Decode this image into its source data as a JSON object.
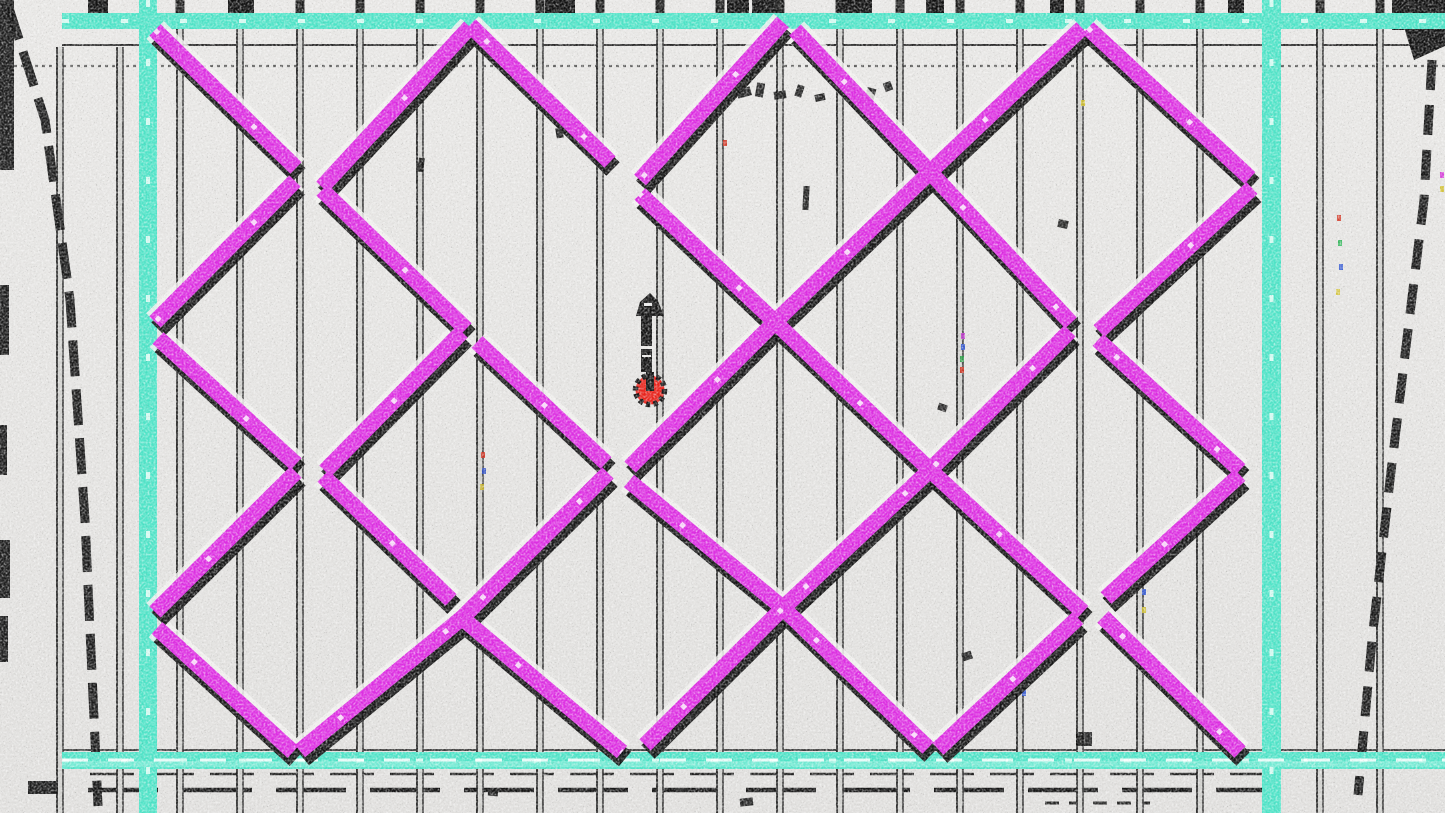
{
  "meta": {
    "title": "Colorized blueprint maze — red player token with up arrow"
  },
  "canvas": {
    "width": 1445,
    "height": 813
  },
  "colors": {
    "background": "#e2e1df",
    "background_top": "#e7e6e4",
    "wall": "#dd2fe2",
    "wall_shadow": "#0c0c0c",
    "wall_halo": "#f2f1ef",
    "wall_fleck": "#ffffff",
    "frame": "#4fe3c7",
    "frame_light": "#8ff0dd",
    "frame_speckle": "#f4fffb",
    "post_core": "#cfcfcc",
    "post_edge": "#1a1a1a",
    "ink": "#111111",
    "player": "#e8241c",
    "arrow": "#141414"
  },
  "frame": {
    "top": {
      "x": 62,
      "y": 13,
      "w": 1383,
      "h": 16
    },
    "bottom": {
      "x": 62,
      "y": 752,
      "w": 1383,
      "h": 17
    },
    "left": {
      "x": 139,
      "y": 0,
      "w": 18,
      "h": 813
    },
    "right": {
      "x": 1262,
      "y": 0,
      "w": 19,
      "h": 813
    }
  },
  "posts": {
    "width": 7,
    "items": [
      {
        "x": 60,
        "top": 47
      },
      {
        "x": 120,
        "top": 47
      },
      {
        "x": 180,
        "top": 0
      },
      {
        "x": 240,
        "top": 0
      },
      {
        "x": 300,
        "top": 0
      },
      {
        "x": 360,
        "top": 0
      },
      {
        "x": 420,
        "top": 0
      },
      {
        "x": 480,
        "top": 0
      },
      {
        "x": 540,
        "top": 0
      },
      {
        "x": 600,
        "top": 0
      },
      {
        "x": 660,
        "top": 0
      },
      {
        "x": 720,
        "top": 0
      },
      {
        "x": 780,
        "top": 0
      },
      {
        "x": 840,
        "top": 0
      },
      {
        "x": 900,
        "top": 0
      },
      {
        "x": 960,
        "top": 0
      },
      {
        "x": 1020,
        "top": 0
      },
      {
        "x": 1080,
        "top": 0
      },
      {
        "x": 1140,
        "top": 0
      },
      {
        "x": 1200,
        "top": 0
      },
      {
        "x": 1320,
        "top": 0
      },
      {
        "x": 1380,
        "top": 0
      }
    ]
  },
  "walls": {
    "width": 16,
    "shadow_width": 19,
    "shadow_dx": 3,
    "shadow_dy": 7,
    "segments": [
      [
        155,
        30,
        296,
        168
      ],
      [
        322,
        190,
        466,
        329
      ],
      [
        477,
        342,
        606,
        463
      ],
      [
        629,
        481,
        783,
        608
      ],
      [
        783,
        608,
        928,
        748
      ],
      [
        470,
        25,
        610,
        162
      ],
      [
        640,
        194,
        775,
        322
      ],
      [
        775,
        322,
        930,
        470
      ],
      [
        930,
        470,
        1083,
        612
      ],
      [
        795,
        30,
        930,
        172
      ],
      [
        930,
        172,
        1071,
        323
      ],
      [
        1098,
        340,
        1240,
        470
      ],
      [
        1088,
        28,
        1250,
        178
      ],
      [
        158,
        338,
        296,
        464
      ],
      [
        323,
        476,
        451,
        600
      ],
      [
        462,
        618,
        622,
        752
      ],
      [
        157,
        628,
        293,
        752
      ],
      [
        1103,
        617,
        1240,
        752
      ],
      [
        155,
        322,
        295,
        181
      ],
      [
        322,
        187,
        470,
        27
      ],
      [
        325,
        471,
        462,
        332
      ],
      [
        155,
        612,
        296,
        472
      ],
      [
        300,
        751,
        462,
        618
      ],
      [
        462,
        618,
        608,
        473
      ],
      [
        640,
        180,
        783,
        22
      ],
      [
        630,
        467,
        775,
        322
      ],
      [
        775,
        322,
        929,
        173
      ],
      [
        929,
        173,
        1082,
        28
      ],
      [
        645,
        745,
        783,
        608
      ],
      [
        783,
        608,
        929,
        471
      ],
      [
        930,
        470,
        1070,
        331
      ],
      [
        1099,
        331,
        1252,
        188
      ],
      [
        938,
        749,
        1078,
        618
      ],
      [
        1106,
        598,
        1240,
        475
      ]
    ]
  },
  "guides": [
    {
      "x1": 62,
      "y1": 45,
      "x2": 1445,
      "y2": 45,
      "w": 2,
      "dash": "none",
      "color": "#1a1a1a",
      "opacity": 0.9
    },
    {
      "x1": 0,
      "y1": 66,
      "x2": 1445,
      "y2": 66,
      "w": 2.2,
      "dash": "3 4",
      "color": "#4a4a4a",
      "opacity": 0.85
    },
    {
      "x1": 62,
      "y1": 750,
      "x2": 1445,
      "y2": 750,
      "w": 2,
      "dash": "none",
      "color": "#161616",
      "opacity": 0.8
    },
    {
      "x1": 90,
      "y1": 774,
      "x2": 1280,
      "y2": 774,
      "w": 2.5,
      "dash": "44 16",
      "color": "#101010",
      "opacity": 0.9
    },
    {
      "x1": 88,
      "y1": 790,
      "x2": 1262,
      "y2": 790,
      "w": 4.5,
      "dash": "70 24",
      "color": "#0d0d0d",
      "opacity": 0.95
    },
    {
      "x1": 1045,
      "y1": 803,
      "x2": 1150,
      "y2": 803,
      "w": 3,
      "dash": "14 10",
      "color": "#101010",
      "opacity": 0.9
    }
  ],
  "diagonals": {
    "width": 9,
    "left_points": "8,5 45,120 70,300 85,520 98,806",
    "left_dash": "36 13",
    "right_points": "1432,60 1424,200 1408,330 1390,480 1372,640 1358,795",
    "right_dash": "30 15"
  },
  "stubs": [
    {
      "x": 88,
      "w": 20,
      "h": 20
    },
    {
      "x": 228,
      "w": 26,
      "h": 22
    },
    {
      "x": 545,
      "w": 30,
      "h": 26
    },
    {
      "x": 727,
      "w": 22,
      "h": 20
    },
    {
      "x": 752,
      "w": 24,
      "h": 18
    },
    {
      "x": 838,
      "w": 34,
      "h": 22
    },
    {
      "x": 926,
      "w": 18,
      "h": 26
    },
    {
      "x": 1050,
      "w": 14,
      "h": 22
    },
    {
      "x": 1228,
      "w": 16,
      "h": 22
    },
    {
      "x": 1392,
      "w": 20,
      "h": 30
    }
  ],
  "auto_stub": {
    "w": 9,
    "h": 13
  },
  "blobs": [
    {
      "x": 0,
      "y": 0,
      "w": 14,
      "h": 170
    },
    {
      "x": 0,
      "y": 285,
      "w": 9,
      "h": 70
    },
    {
      "x": 0,
      "y": 425,
      "w": 7,
      "h": 50
    },
    {
      "x": 0,
      "y": 540,
      "w": 10,
      "h": 58
    },
    {
      "x": 0,
      "y": 616,
      "w": 8,
      "h": 46
    },
    {
      "x": 28,
      "y": 781,
      "w": 30,
      "h": 13
    }
  ],
  "corner_tr": "1396,0 1445,0 1445,46 1414,60",
  "scribbles": [
    {
      "x": 737,
      "y": 88,
      "w": 14,
      "h": 9,
      "r": -15
    },
    {
      "x": 756,
      "y": 83,
      "w": 8,
      "h": 14,
      "r": 10
    },
    {
      "x": 774,
      "y": 91,
      "w": 12,
      "h": 8,
      "r": -8
    },
    {
      "x": 796,
      "y": 85,
      "w": 7,
      "h": 12,
      "r": 18
    },
    {
      "x": 815,
      "y": 94,
      "w": 10,
      "h": 7,
      "r": -12
    },
    {
      "x": 845,
      "y": 84,
      "w": 12,
      "h": 9,
      "r": -10
    },
    {
      "x": 866,
      "y": 88,
      "w": 9,
      "h": 12,
      "r": 15
    },
    {
      "x": 884,
      "y": 82,
      "w": 8,
      "h": 9,
      "r": -20
    },
    {
      "x": 803,
      "y": 186,
      "w": 6,
      "h": 24,
      "r": 3
    },
    {
      "x": 938,
      "y": 404,
      "w": 9,
      "h": 7,
      "r": 20
    },
    {
      "x": 740,
      "y": 798,
      "w": 13,
      "h": 8,
      "r": -6
    },
    {
      "x": 1076,
      "y": 732,
      "w": 16,
      "h": 14,
      "r": 0
    },
    {
      "x": 418,
      "y": 158,
      "w": 6,
      "h": 14,
      "r": 8
    },
    {
      "x": 962,
      "y": 652,
      "w": 10,
      "h": 8,
      "r": -18
    },
    {
      "x": 556,
      "y": 128,
      "w": 7,
      "h": 10,
      "r": -10
    },
    {
      "x": 1058,
      "y": 220,
      "w": 10,
      "h": 8,
      "r": 12
    },
    {
      "x": 488,
      "y": 790,
      "w": 10,
      "h": 6,
      "r": 5
    }
  ],
  "specks": [
    {
      "x": 481,
      "y": 452,
      "c": "#cf3322"
    },
    {
      "x": 482,
      "y": 468,
      "c": "#2f4fc4"
    },
    {
      "x": 480,
      "y": 484,
      "c": "#c9b42a"
    },
    {
      "x": 961,
      "y": 333,
      "c": "#bb33c9"
    },
    {
      "x": 961,
      "y": 344,
      "c": "#3055d2"
    },
    {
      "x": 960,
      "y": 356,
      "c": "#2da04a"
    },
    {
      "x": 960,
      "y": 367,
      "c": "#d03321"
    },
    {
      "x": 1141,
      "y": 570,
      "c": "#d03321"
    },
    {
      "x": 1142,
      "y": 589,
      "c": "#3055d2"
    },
    {
      "x": 1142,
      "y": 607,
      "c": "#d2c133"
    },
    {
      "x": 1337,
      "y": 215,
      "c": "#d03321"
    },
    {
      "x": 1338,
      "y": 240,
      "c": "#2eb457"
    },
    {
      "x": 1339,
      "y": 264,
      "c": "#3055d2"
    },
    {
      "x": 1336,
      "y": 289,
      "c": "#d2c133"
    },
    {
      "x": 1440,
      "y": 172,
      "c": "#d435d8"
    },
    {
      "x": 1440,
      "y": 186,
      "c": "#d2c133"
    },
    {
      "x": 723,
      "y": 140,
      "c": "#d03321"
    },
    {
      "x": 1081,
      "y": 100,
      "c": "#d2c133"
    },
    {
      "x": 1022,
      "y": 690,
      "c": "#3055d2"
    }
  ],
  "player": {
    "dot": {
      "cx": 650,
      "cy": 390,
      "r": 14.5,
      "spike_width": 5.5,
      "spike_dash": "4.2 3.3"
    },
    "stem": {
      "x": 646,
      "y": 372,
      "w": 8,
      "h": 19
    },
    "arrow": {
      "head": "650,293 640,302 636,316 664,316 658,301",
      "shaft": {
        "x": 641,
        "y": 314,
        "w": 11,
        "h": 58
      },
      "head_nick": {
        "x": 644,
        "y": 303,
        "w": 8,
        "h": 3
      },
      "nicks": [
        {
          "x": 640,
          "y": 346,
          "w": 13,
          "h": 3
        },
        {
          "x": 642,
          "y": 355,
          "w": 9,
          "h": 2
        }
      ]
    }
  }
}
